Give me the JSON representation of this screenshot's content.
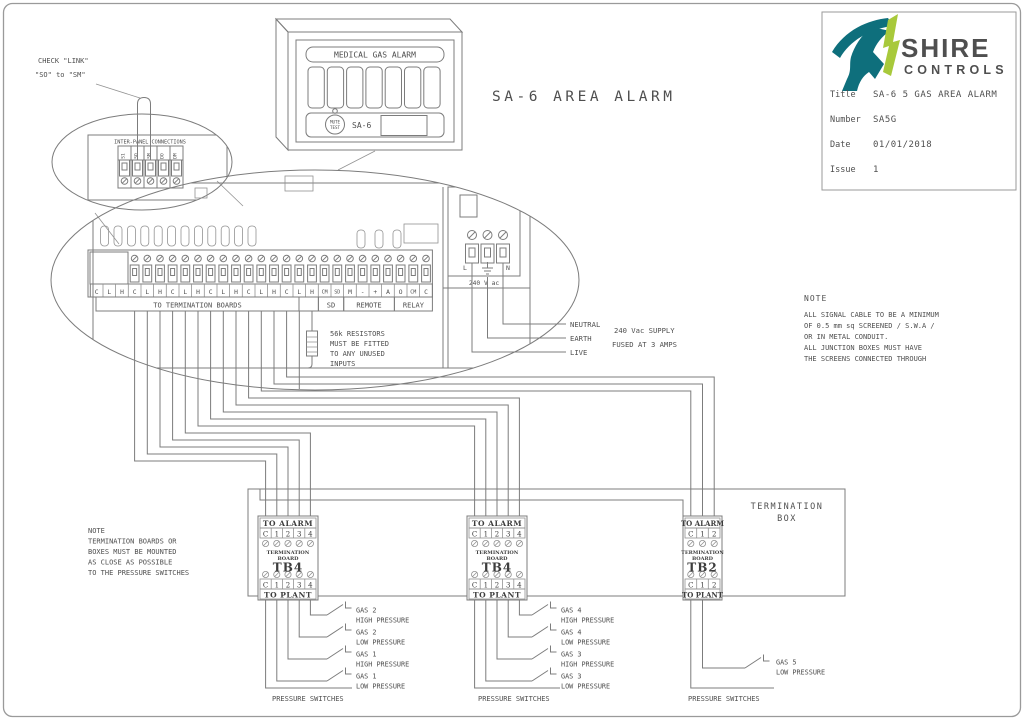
{
  "colors": {
    "teal": "#0E6F7C",
    "green": "#A8C93B",
    "line": "#7c7c7c",
    "text": "#4f4f4f"
  },
  "diagram_title": "SA-6 AREA ALARM",
  "title_block": {
    "brand": {
      "name": "SHIRE",
      "sub": "CONTROLS"
    },
    "rows": [
      {
        "label": "Title",
        "value": "SA-6 5 GAS AREA ALARM"
      },
      {
        "label": "Number",
        "value": "SA5G"
      },
      {
        "label": "Date",
        "value": "01/01/2018"
      },
      {
        "label": "Issue",
        "value": "1"
      }
    ]
  },
  "check_link_note": {
    "line1": "CHECK \"LINK\"",
    "line2": "\"SO\" to \"SM\""
  },
  "inter_panel": {
    "title": "INTER-PANEL CONNECTIONS",
    "terminals": [
      "S1",
      "SO",
      "SM",
      "DO",
      "DM"
    ]
  },
  "alarm_panel": {
    "header": "MEDICAL GAS ALARM",
    "button_line1": "MUTE",
    "button_line2": "TEST",
    "model": "SA-6"
  },
  "strip": {
    "labels": [
      "C",
      "L",
      "H",
      "C",
      "L",
      "H",
      "C",
      "L",
      "H",
      "C",
      "L",
      "H",
      "C",
      "L",
      "H",
      "C",
      "L",
      "H",
      "CM",
      "SD",
      "M",
      "-",
      "+",
      "A",
      "O",
      "CM",
      "C"
    ],
    "groups": [
      "TO TERMINATION BOARDS",
      "SD",
      "REMOTE",
      "RELAY"
    ]
  },
  "mains": {
    "l": "L",
    "n": "N",
    "voltage": "240 V ac",
    "wire_labels": [
      "NEUTRAL",
      "EARTH",
      "LIVE"
    ],
    "supply_line1": "240 Vac SUPPLY",
    "supply_line2": "FUSED AT 3 AMPS"
  },
  "resistor_note": {
    "lines": [
      "56k RESISTORS",
      "MUST BE FITTED",
      "TO ANY UNUSED",
      "INPUTS"
    ]
  },
  "signal_note": {
    "title": "NOTE",
    "lines": [
      "ALL SIGNAL CABLE TO BE A MINIMUM",
      "OF 0.5 mm sq SCREENED / S.W.A /",
      "OR IN METAL CONDUIT.",
      "ALL JUNCTION BOXES MUST HAVE",
      "THE SCREENS CONNECTED THROUGH"
    ]
  },
  "mounting_note": {
    "lines": [
      "NOTE",
      "TERMINATION BOARDS OR",
      "BOXES MUST BE MOUNTED",
      "AS CLOSE AS POSSIBLE",
      "TO THE PRESSURE SWITCHES"
    ]
  },
  "termination_box": {
    "label_line1": "TERMINATION",
    "label_line2": "BOX"
  },
  "boards": [
    {
      "to_alarm": "TO ALARM",
      "top_cells": [
        "C",
        "1",
        "2",
        "3",
        "4"
      ],
      "sub1": "TERMINATION",
      "sub2": "BOARD",
      "name": "TB4",
      "bottom_cells": [
        "C",
        "1",
        "2",
        "3",
        "4"
      ],
      "to_plant": "TO PLANT"
    },
    {
      "to_alarm": "TO ALARM",
      "top_cells": [
        "C",
        "1",
        "2",
        "3",
        "4"
      ],
      "sub1": "TERMINATION",
      "sub2": "BOARD",
      "name": "TB4",
      "bottom_cells": [
        "C",
        "1",
        "2",
        "3",
        "4"
      ],
      "to_plant": "TO PLANT"
    },
    {
      "to_alarm": "TO ALARM",
      "top_cells": [
        "C",
        "1",
        "2"
      ],
      "sub1": "TERMINATION",
      "sub2": "BOARD",
      "name": "TB2",
      "bottom_cells": [
        "C",
        "1",
        "2"
      ],
      "to_plant": "TO PLANT"
    }
  ],
  "pressure_groups": [
    {
      "caption": "PRESSURE SWITCHES",
      "switches": [
        {
          "gas": "GAS 2",
          "level": "HIGH PRESSURE"
        },
        {
          "gas": "GAS 2",
          "level": "LOW PRESSURE"
        },
        {
          "gas": "GAS 1",
          "level": "HIGH PRESSURE"
        },
        {
          "gas": "GAS 1",
          "level": "LOW PRESSURE"
        }
      ]
    },
    {
      "caption": "PRESSURE SWITCHES",
      "switches": [
        {
          "gas": "GAS 4",
          "level": "HIGH PRESSURE"
        },
        {
          "gas": "GAS 4",
          "level": "LOW PRESSURE"
        },
        {
          "gas": "GAS 3",
          "level": "HIGH PRESSURE"
        },
        {
          "gas": "GAS 3",
          "level": "LOW PRESSURE"
        }
      ]
    },
    {
      "caption": "PRESSURE SWITCHES",
      "switches": [
        {
          "gas": "GAS 5",
          "level": "LOW PRESSURE"
        }
      ]
    }
  ]
}
